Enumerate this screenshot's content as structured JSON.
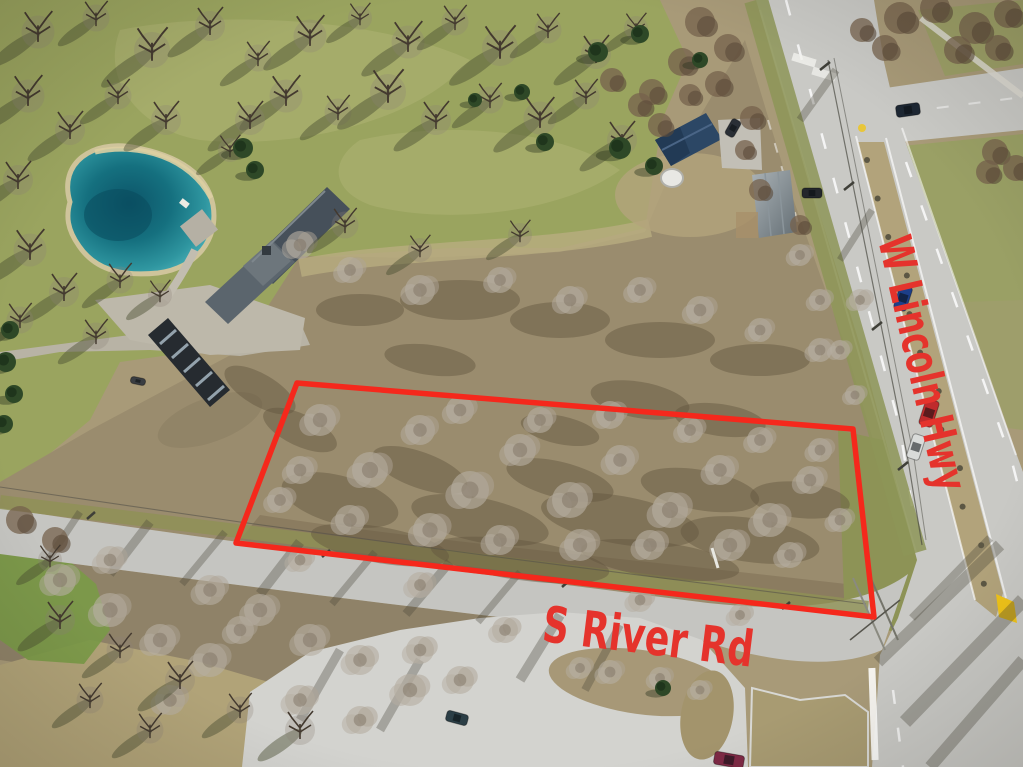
{
  "annotations": {
    "parcel_outline": {
      "color": "#f5281c",
      "stroke_width": 5.5,
      "corners": [
        [
          297,
          383
        ],
        [
          853,
          429
        ],
        [
          874,
          617
        ],
        [
          236,
          543
        ]
      ]
    },
    "labels": [
      {
        "id": "w-lincoln-hwy",
        "text": "W Lincoln Hwy",
        "color": "#e5332c",
        "x": 878,
        "y": 240,
        "angle_deg": 77,
        "font_size": 46,
        "text_length": 260
      },
      {
        "id": "s-river-rd",
        "text": "S River Rd",
        "color": "#e5332c",
        "x": 541,
        "y": 641,
        "angle_deg": 7,
        "font_size": 50,
        "text_length": 212
      }
    ]
  },
  "palette": {
    "annotation_red": "#f5281c",
    "label_red": "#e5332c",
    "pond_deep": "#0e5f72",
    "pond_light": "#4fb3ba",
    "lawn_green": "#9aa45f",
    "field_tan": "#ab9d79",
    "scrub_brown": "#9a8c6e",
    "pavement_gray": "#c9c9c5",
    "pavement_light": "#d3d3cf",
    "yellow_curb": "#f0c419",
    "evergreen": "#2e4827"
  },
  "scene_features": [
    "teal-pond",
    "main-house",
    "outbuilding",
    "blue-roof-house",
    "dome-shed",
    "utility-building",
    "vacant-parcel-scrub",
    "w-lincoln-hwy-road",
    "s-river-rd-road",
    "side-road",
    "parking-lot",
    "median-island",
    "power-lines",
    "cars"
  ]
}
